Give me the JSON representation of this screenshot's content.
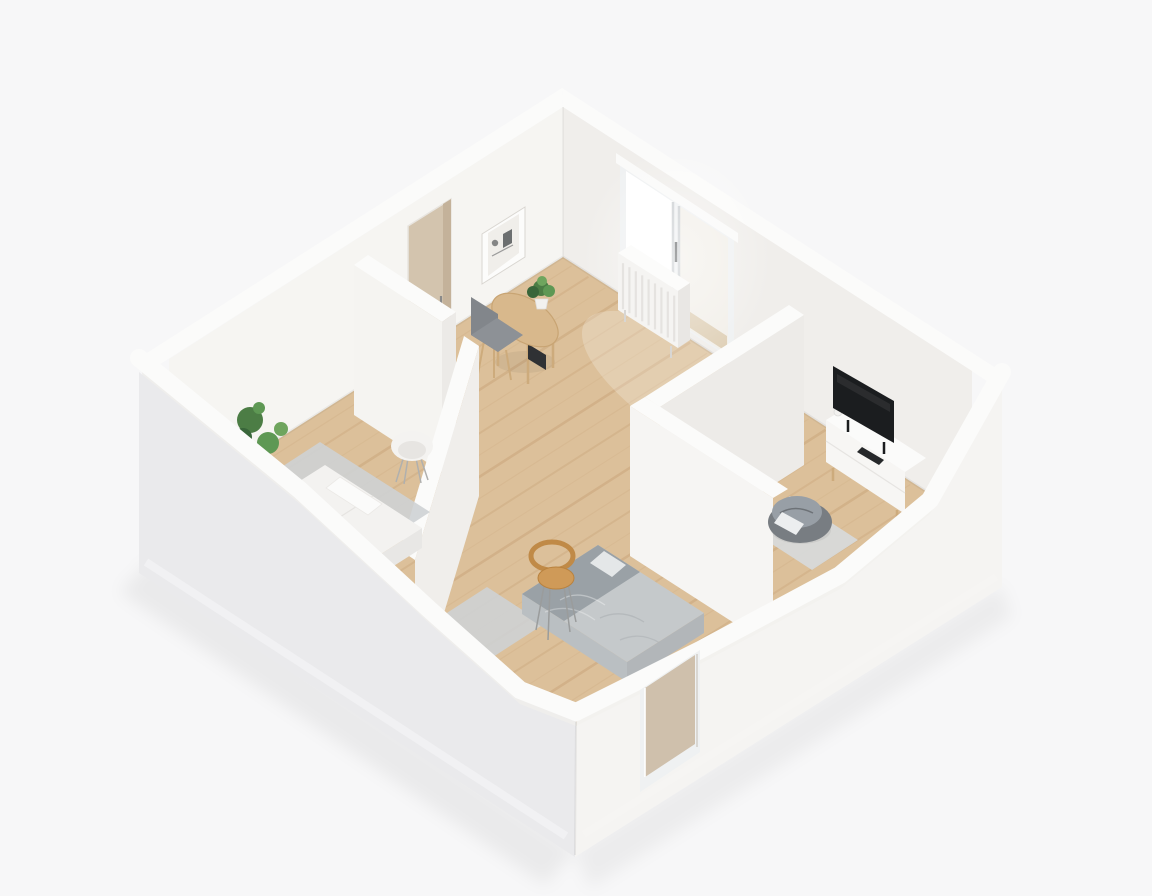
{
  "page": {
    "description": "3D isometric cutaway rendering of a small apartment floor plan, white walls, light oak floors",
    "view": "isometric-cutaway",
    "style": "minimal white architectural render"
  },
  "rooms": [
    {
      "id": "living-room",
      "label": "Living room / studio",
      "furniture": [
        "wall-art",
        "interior-door",
        "desk",
        "desk-chair",
        "desk-plant",
        "radiator",
        "sliding-window"
      ]
    },
    {
      "id": "left-bedroom",
      "label": "Bedroom (left)",
      "furniture": [
        "double-bed-white",
        "pillow",
        "area-rug",
        "tub-chair",
        "potted-plant"
      ]
    },
    {
      "id": "front-bedroom",
      "label": "Bedroom (front)",
      "furniture": [
        "double-bed-gray",
        "blanket",
        "pillow",
        "wooden-chair",
        "area-rug"
      ]
    },
    {
      "id": "tv-room",
      "label": "Media room",
      "furniture": [
        "media-console",
        "tv",
        "remote",
        "vase",
        "area-rug",
        "bean-bag",
        "floor-cushion"
      ]
    },
    {
      "id": "hallway",
      "label": "Hallway",
      "furniture": []
    }
  ],
  "exterior": {
    "windows": [
      "front-facade-window"
    ],
    "features": [
      "plinth",
      "front-corner"
    ]
  },
  "colors": {
    "background": "#f7f7f8",
    "shadow": "#000000",
    "band": "#fbfbfa",
    "northFace": "#f0eeeb",
    "westFace": "#f6f5f2",
    "wedgeLeft": "#efeeec",
    "wedgeRight": "#f3f2ef",
    "extLeft": "#eaeaec",
    "extRight": "#f5f4f2",
    "plinthLeft": "#f2f2f4",
    "plinthRight": "#f7f6f4",
    "floor": "#dcc09a",
    "plank": "#b08050",
    "pool": "#ffffff",
    "w1Face": "#f5f4f1",
    "w1End": "#eceae7",
    "w2Face": "#f0eeeb",
    "w3Face": "#edebe8",
    "w4Face": "#f6f5f3",
    "artFrame": "#fcfcfb",
    "artInner": "#f0eeea",
    "artInk": "#55585a",
    "doorTan": "#d3c4ae",
    "doorTanDark": "#c4b29a",
    "doorHandle": "#8a8a8a",
    "windowFrame": "#eff1f2",
    "pelmet": "#fafaf9",
    "glassBright": "#ffffff",
    "glassTint": "#f2efe9",
    "balconyTan": "#d8c5a6",
    "mullion": "#c9cdd0",
    "handleDark": "#55585a",
    "radiatorFront": "#f5f4f2",
    "radiatorTop": "#fcfcfb",
    "radiatorEnd": "#e9e7e4",
    "fin": "#e5e3e0",
    "deskWood": "#d8b88c",
    "deskEdge": "#c8a473",
    "legWood": "#cdab7c",
    "pc": "#2f3134",
    "potWhite": "#f2f1ef",
    "plantDeep": "#39663a",
    "plantDark": "#4c7d45",
    "plantMid": "#5e9854",
    "plantLight": "#6fa55e",
    "chairSeat": "#8d9196",
    "chairBack": "#82868b",
    "consoleFront": "#f7f6f4",
    "consoleTop": "#fbfbfa",
    "consoleSeam": "#e6e4e1",
    "tv": "#1b1d1f",
    "remote": "#26282a",
    "rugTv": "#d7dadb",
    "beanBase": "#787d82",
    "beanTop": "#989fa6",
    "beanCrease": "#6d7277",
    "cushionWhite": "#eceeef",
    "rugGray": "#ced2d4",
    "bedWhite": "#f3f2f0",
    "bedWhiteSide": "#e8e7e5",
    "bedSeam": "#e6e4e1",
    "pillowWhite": "#fbfbfa",
    "tubChair": "#f4f3f1",
    "tubChairInner": "#e7e5e2",
    "wireLeg": "#b0b0ae",
    "woodSeat": "#cf9a58",
    "woodBack": "#c08a47",
    "chairLegMetal": "#9a9c9c",
    "bedGray": "#c5c9cb",
    "bedGraySideA": "#b2b6b9",
    "bedGraySideB": "#babfc2",
    "blanketGray": "#9aa1a6",
    "foldLight": "#ffffff",
    "foldDark": "#b0b5b8",
    "glassTan": "#c9b7a0"
  }
}
